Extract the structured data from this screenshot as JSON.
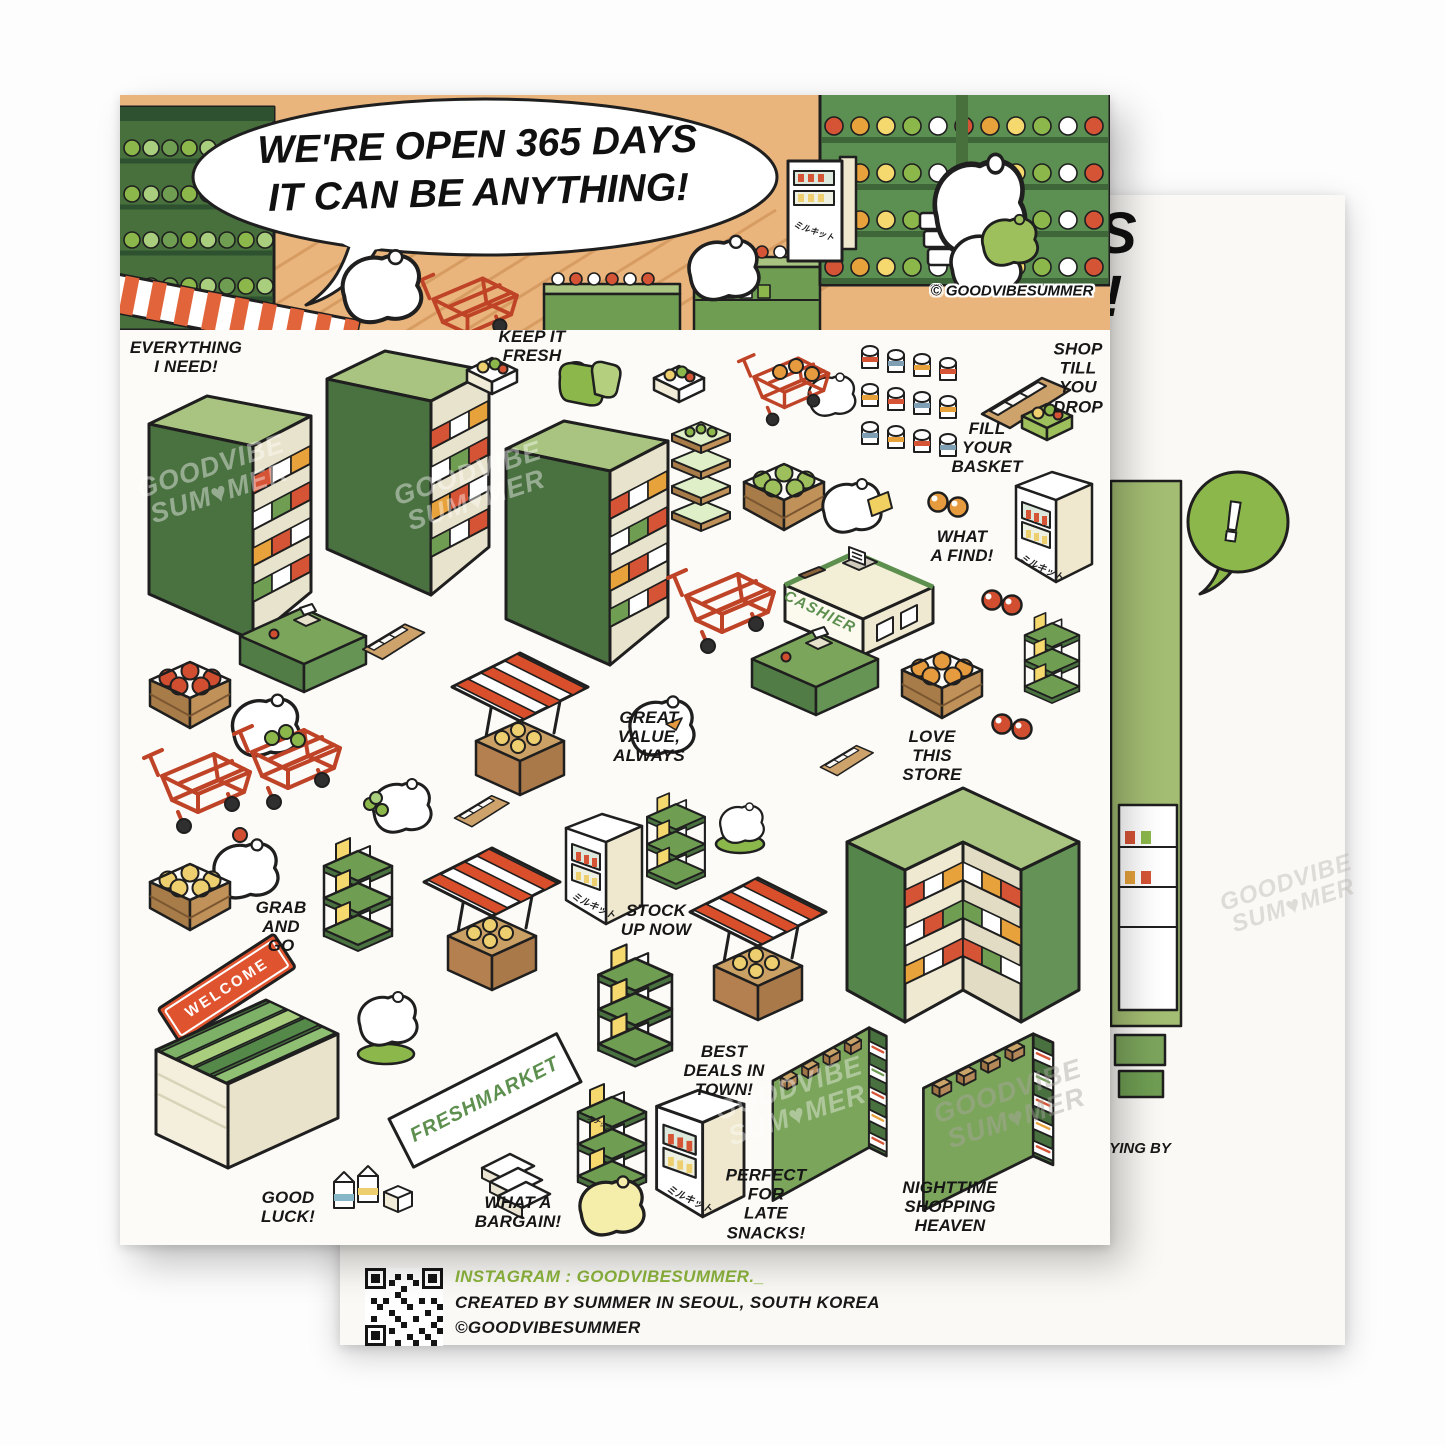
{
  "banner": {
    "speech_bubble": "WE'RE OPEN 365 DAYS\nIT CAN BE ANYTHING!",
    "artist_credit": "© GOODVIBESUMMER"
  },
  "labels": {
    "everything_i_need": "EVERYTHING\nI NEED!",
    "keep_it_fresh": "KEEP IT\nFRESH",
    "shop_till_you_drop": "SHOP\nTILL\nYOU\nDROP",
    "fill_your_basket": "FILL\nYOUR\nBASKET",
    "what_a_find": "WHAT\nA FIND!",
    "great_value_always": "GREAT\nVALUE,\nALWAYS",
    "love_this_store": "LOVE\nTHIS\nSTORE",
    "grab_and_go": "GRAB\nAND\nGO",
    "stock_up_now": "STOCK\nUP NOW",
    "best_deals_in_town": "BEST\nDEALS IN\nTOWN!",
    "good_luck": "GOOD\nLUCK!",
    "what_a_bargain": "WHAT A\nBARGAIN!",
    "perfect_for_late_snacks": "PERFECT\nFOR\nLATE\nSNACKS!",
    "nighttime_shopping_heaven": "NIGHTTIME\nSHOPPING\nHEAVEN"
  },
  "signs": {
    "welcome": "WELCOME",
    "freshmarket": "FRESHMARKET",
    "cashier": "CASHIER",
    "meal_kit_machine": "ミルキット",
    "snack_pack": "スナック"
  },
  "watermark": "GOODVIBE\nSUM♥MER",
  "back_sheet": {
    "partial_letters": [
      "S",
      "!"
    ],
    "exclamation": "!",
    "flying_by": "FLYING BY"
  },
  "footer": {
    "instagram": "INSTAGRAM : GOODVIBESUMMER._",
    "created_by": "CREATED BY SUMMER IN SEOUL, SOUTH KOREA",
    "copyright": "©GOODVIBESUMMER"
  },
  "colors": {
    "accent_green": "#8cb43c",
    "shelf_green": "#6f9e53",
    "sign_red": "#e0532f",
    "wood": "#e9b57d"
  }
}
